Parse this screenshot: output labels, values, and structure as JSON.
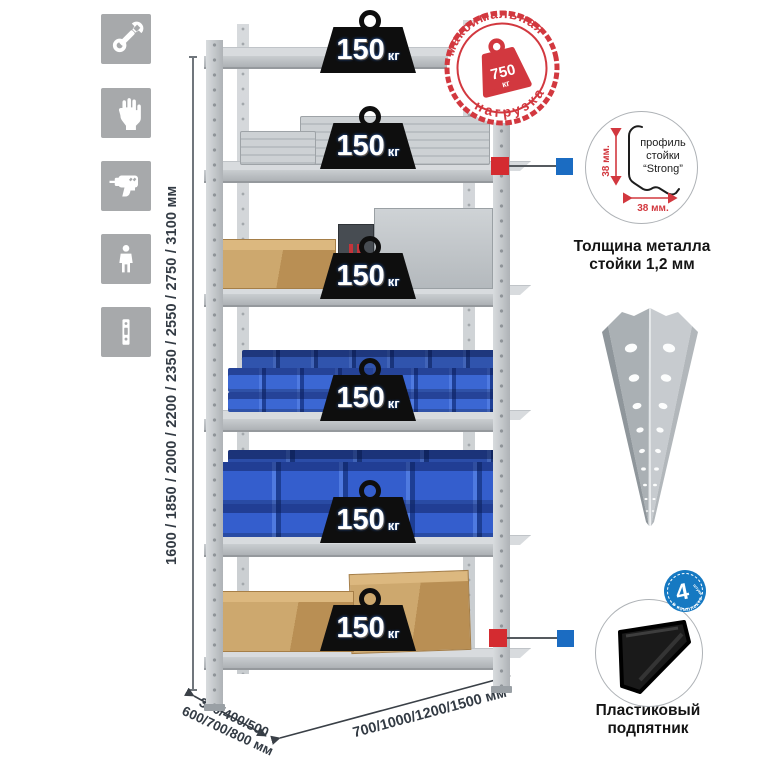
{
  "feature_icons": [
    {
      "id": "wrench-icon"
    },
    {
      "id": "gloves-icon"
    },
    {
      "id": "drill-icon"
    },
    {
      "id": "person-icon"
    },
    {
      "id": "upright-profile-icon"
    }
  ],
  "dimensions": {
    "height": "1600 / 1850 / 2000 / 2200 / 2350 / 2550 / 2750 / 3100 мм",
    "depth_line1": "300/400/500",
    "depth_line2": "600/700/800 мм",
    "width": "700/1000/1200/1500 мм"
  },
  "shelf_badge": {
    "value": "150",
    "unit": "кг"
  },
  "max_load_stamp": {
    "arc_top": "максимальная",
    "arc_bottom": "нагрузка",
    "value": "750",
    "unit": "кг"
  },
  "profile_callout": {
    "label_line1": "профиль",
    "label_line2": "стойки",
    "label_line3": "“Strong”",
    "dim_vertical": "38 мм.",
    "dim_horizontal": "38 мм.",
    "caption_line1": "Толщина металла",
    "caption_line2": "стойки 1,2 мм"
  },
  "foot_callout": {
    "badge_value": "4",
    "badge_small": "штуки",
    "badge_arc": "в комплекте",
    "caption_line1": "Пластиковый",
    "caption_line2": "подпятник"
  },
  "colors": {
    "stamp_red": "#d2383f",
    "marker_red": "#d42b30",
    "marker_blue": "#1b6cc2",
    "badge_black": "#0e0e0e",
    "bin_blue": "#2f5ecb",
    "metal_gray": "#c6cacd"
  }
}
